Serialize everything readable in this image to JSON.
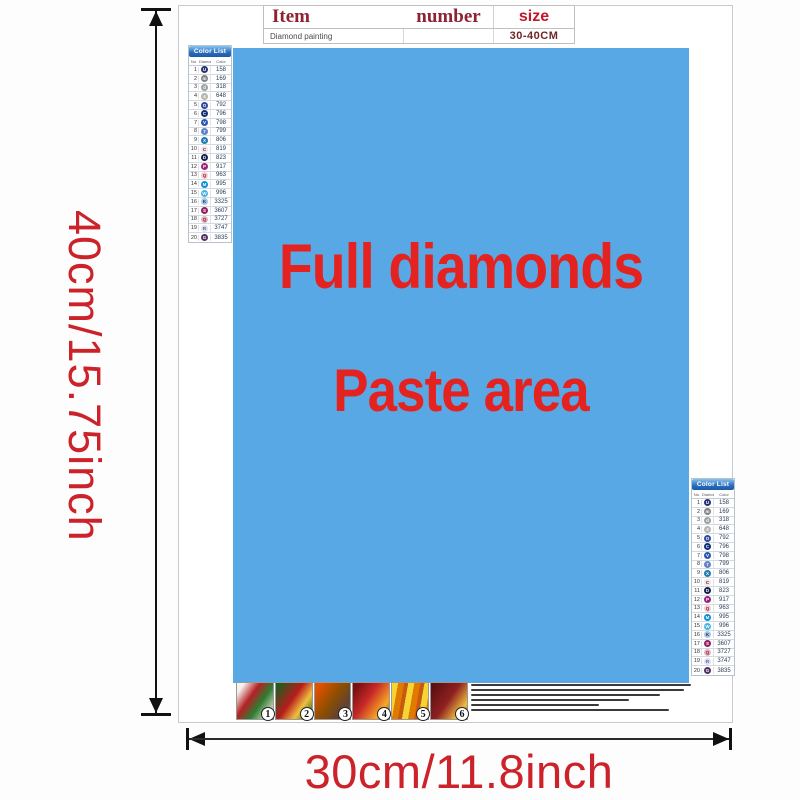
{
  "poster": {
    "table": {
      "item_label": "Item",
      "number_label": "number",
      "size_label": "size",
      "product_name": "Diamond painting",
      "size_value": "30-40CM"
    },
    "paste_area": {
      "line1": "Full diamonds",
      "line2": "Paste area",
      "bg_color": "#58a8e6",
      "text_color": "#e42320"
    },
    "color_list": {
      "header": "Color List",
      "columns": [
        "No.",
        "Diamond",
        "Color"
      ],
      "rows": [
        {
          "no": "1",
          "symbol": "U",
          "code": "158",
          "bg": "#26316e",
          "fg": "#ffffff"
        },
        {
          "no": "2",
          "symbol": "m",
          "code": "169",
          "bg": "#7f8285",
          "fg": "#ffffff"
        },
        {
          "no": "3",
          "symbol": "d",
          "code": "318",
          "bg": "#9aa0a4",
          "fg": "#ffffff"
        },
        {
          "no": "4",
          "symbol": "4",
          "code": "648",
          "bg": "#b3b8ae",
          "fg": "#ffffff"
        },
        {
          "no": "5",
          "symbol": "O",
          "code": "792",
          "bg": "#2f4a9b",
          "fg": "#ffffff"
        },
        {
          "no": "6",
          "symbol": "C",
          "code": "796",
          "bg": "#122f73",
          "fg": "#ffffff"
        },
        {
          "no": "7",
          "symbol": "V",
          "code": "798",
          "bg": "#2b57b0",
          "fg": "#ffffff"
        },
        {
          "no": "8",
          "symbol": "7",
          "code": "799",
          "bg": "#5f82c8",
          "fg": "#ffffff"
        },
        {
          "no": "9",
          "symbol": "X",
          "code": "806",
          "bg": "#1d7cab",
          "fg": "#ffffff"
        },
        {
          "no": "10",
          "symbol": "C",
          "code": "819",
          "bg": "#f7e4e8",
          "fg": "#333333"
        },
        {
          "no": "11",
          "symbol": "D",
          "code": "823",
          "bg": "#15204d",
          "fg": "#ffffff"
        },
        {
          "no": "12",
          "symbol": "P",
          "code": "917",
          "bg": "#99227d",
          "fg": "#ffffff"
        },
        {
          "no": "13",
          "symbol": "Q",
          "code": "963",
          "bg": "#f6c9cd",
          "fg": "#7a2030"
        },
        {
          "no": "14",
          "symbol": "M",
          "code": "995",
          "bg": "#0b8ed0",
          "fg": "#ffffff"
        },
        {
          "no": "15",
          "symbol": "W",
          "code": "996",
          "bg": "#43b2e6",
          "fg": "#ffffff"
        },
        {
          "no": "16",
          "symbol": "K",
          "code": "3325",
          "bg": "#a6c6e4",
          "fg": "#223355"
        },
        {
          "no": "17",
          "symbol": "S",
          "code": "3607",
          "bg": "#8e2060",
          "fg": "#ffffff"
        },
        {
          "no": "18",
          "symbol": "Q",
          "code": "3727",
          "bg": "#e0b4c0",
          "fg": "#8e2040"
        },
        {
          "no": "19",
          "symbol": "R",
          "code": "3747",
          "bg": "#dcdff2",
          "fg": "#666688"
        },
        {
          "no": "20",
          "symbol": "G",
          "code": "3835",
          "bg": "#503061",
          "fg": "#ffffff"
        }
      ]
    },
    "footer": {
      "badges": [
        "1",
        "2",
        "3",
        "4",
        "5",
        "6"
      ]
    }
  },
  "dimensions": {
    "height_label": "40cm/15.75inch",
    "width_label": "30cm/11.8inch",
    "label_color": "#cc2229"
  }
}
